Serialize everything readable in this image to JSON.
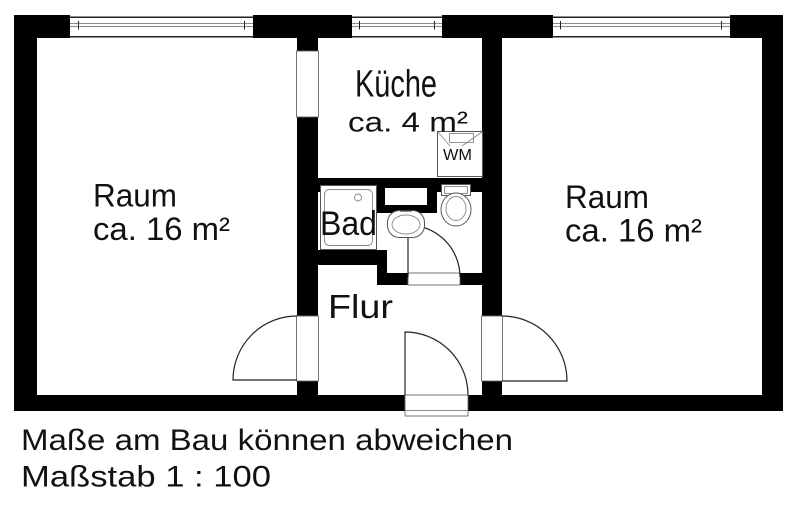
{
  "colors": {
    "wall": "#000000",
    "bg": "#ffffff",
    "fixture_line": "#555555",
    "door_line": "#222222",
    "jamb_line": "#666666",
    "glass_line": "#888888",
    "ink": "#111111"
  },
  "plan": {
    "rooms": {
      "left": {
        "name": "Raum",
        "area": "ca. 16 m²"
      },
      "right": {
        "name": "Raum",
        "area": "ca. 16 m²"
      },
      "kitchen": {
        "name": "Küche",
        "area": "ca. 4 m²"
      },
      "bath": {
        "name": "Bad"
      },
      "hall": {
        "name": "Flur"
      }
    },
    "appliances": {
      "washing_machine": {
        "label": "WM"
      }
    }
  },
  "footer": {
    "disclaimer": "Maße am Bau können abweichen",
    "scale": "Maßstab 1 : 100"
  }
}
